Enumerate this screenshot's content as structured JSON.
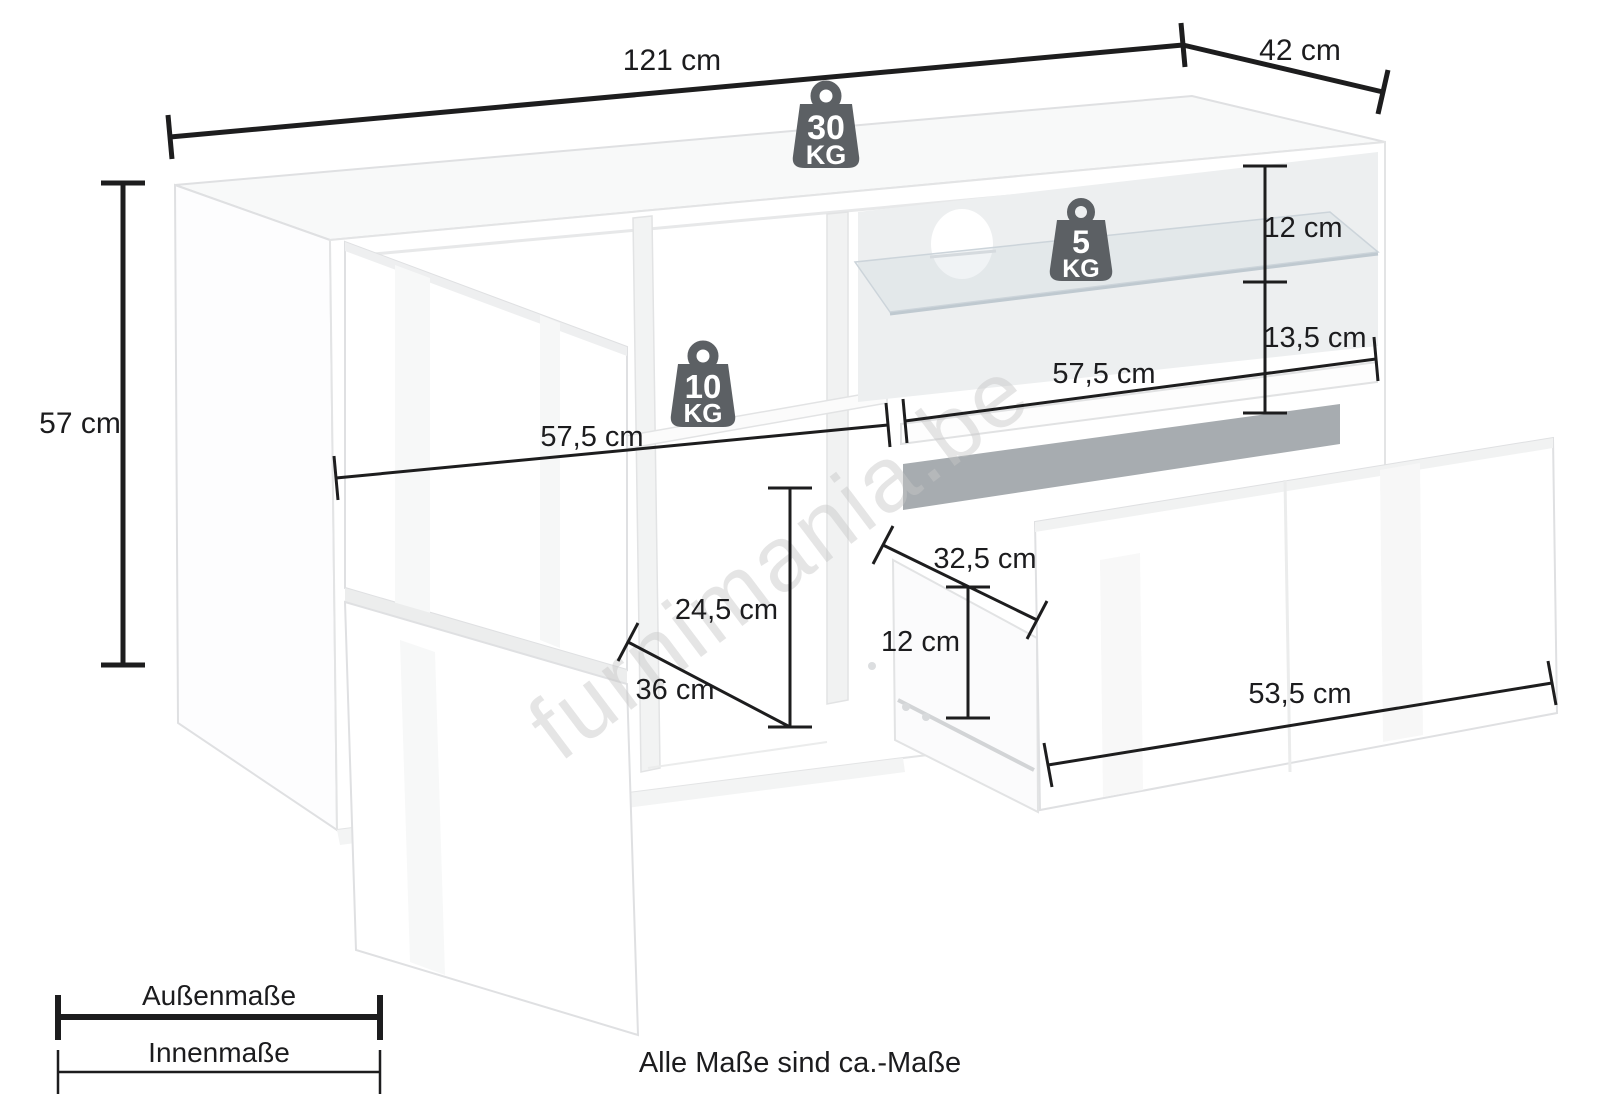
{
  "watermark": "furnimania.be",
  "note": "Alle Maße sind ca.-Maße",
  "legend": {
    "outer_label": "Außenmaße",
    "inner_label": "Innenmaße"
  },
  "weights": {
    "top": {
      "value": "30",
      "unit": "KG"
    },
    "glass_shelf": {
      "value": "5",
      "unit": "KG"
    },
    "mid_shelf": {
      "value": "10",
      "unit": "KG"
    }
  },
  "dimensions": {
    "total_width": "121 cm",
    "total_depth": "42 cm",
    "total_height": "57 cm",
    "glass_upper_height": "12 cm",
    "glass_lower_height": "13,5 cm",
    "inner_width_right": "57,5 cm",
    "inner_width_left": "57,5 cm",
    "inner_height_left": "24,5 cm",
    "inner_depth_left": "36 cm",
    "drawer_depth": "32,5 cm",
    "drawer_height": "12 cm",
    "drawer_width": "53,5 cm"
  },
  "colors": {
    "dimension_line": "#1d1d1e",
    "weight_icon": "#5c6064",
    "drawer_slot": "#a7acb0",
    "back_panel": "#edeff0",
    "outline": "#dfe0e2"
  }
}
